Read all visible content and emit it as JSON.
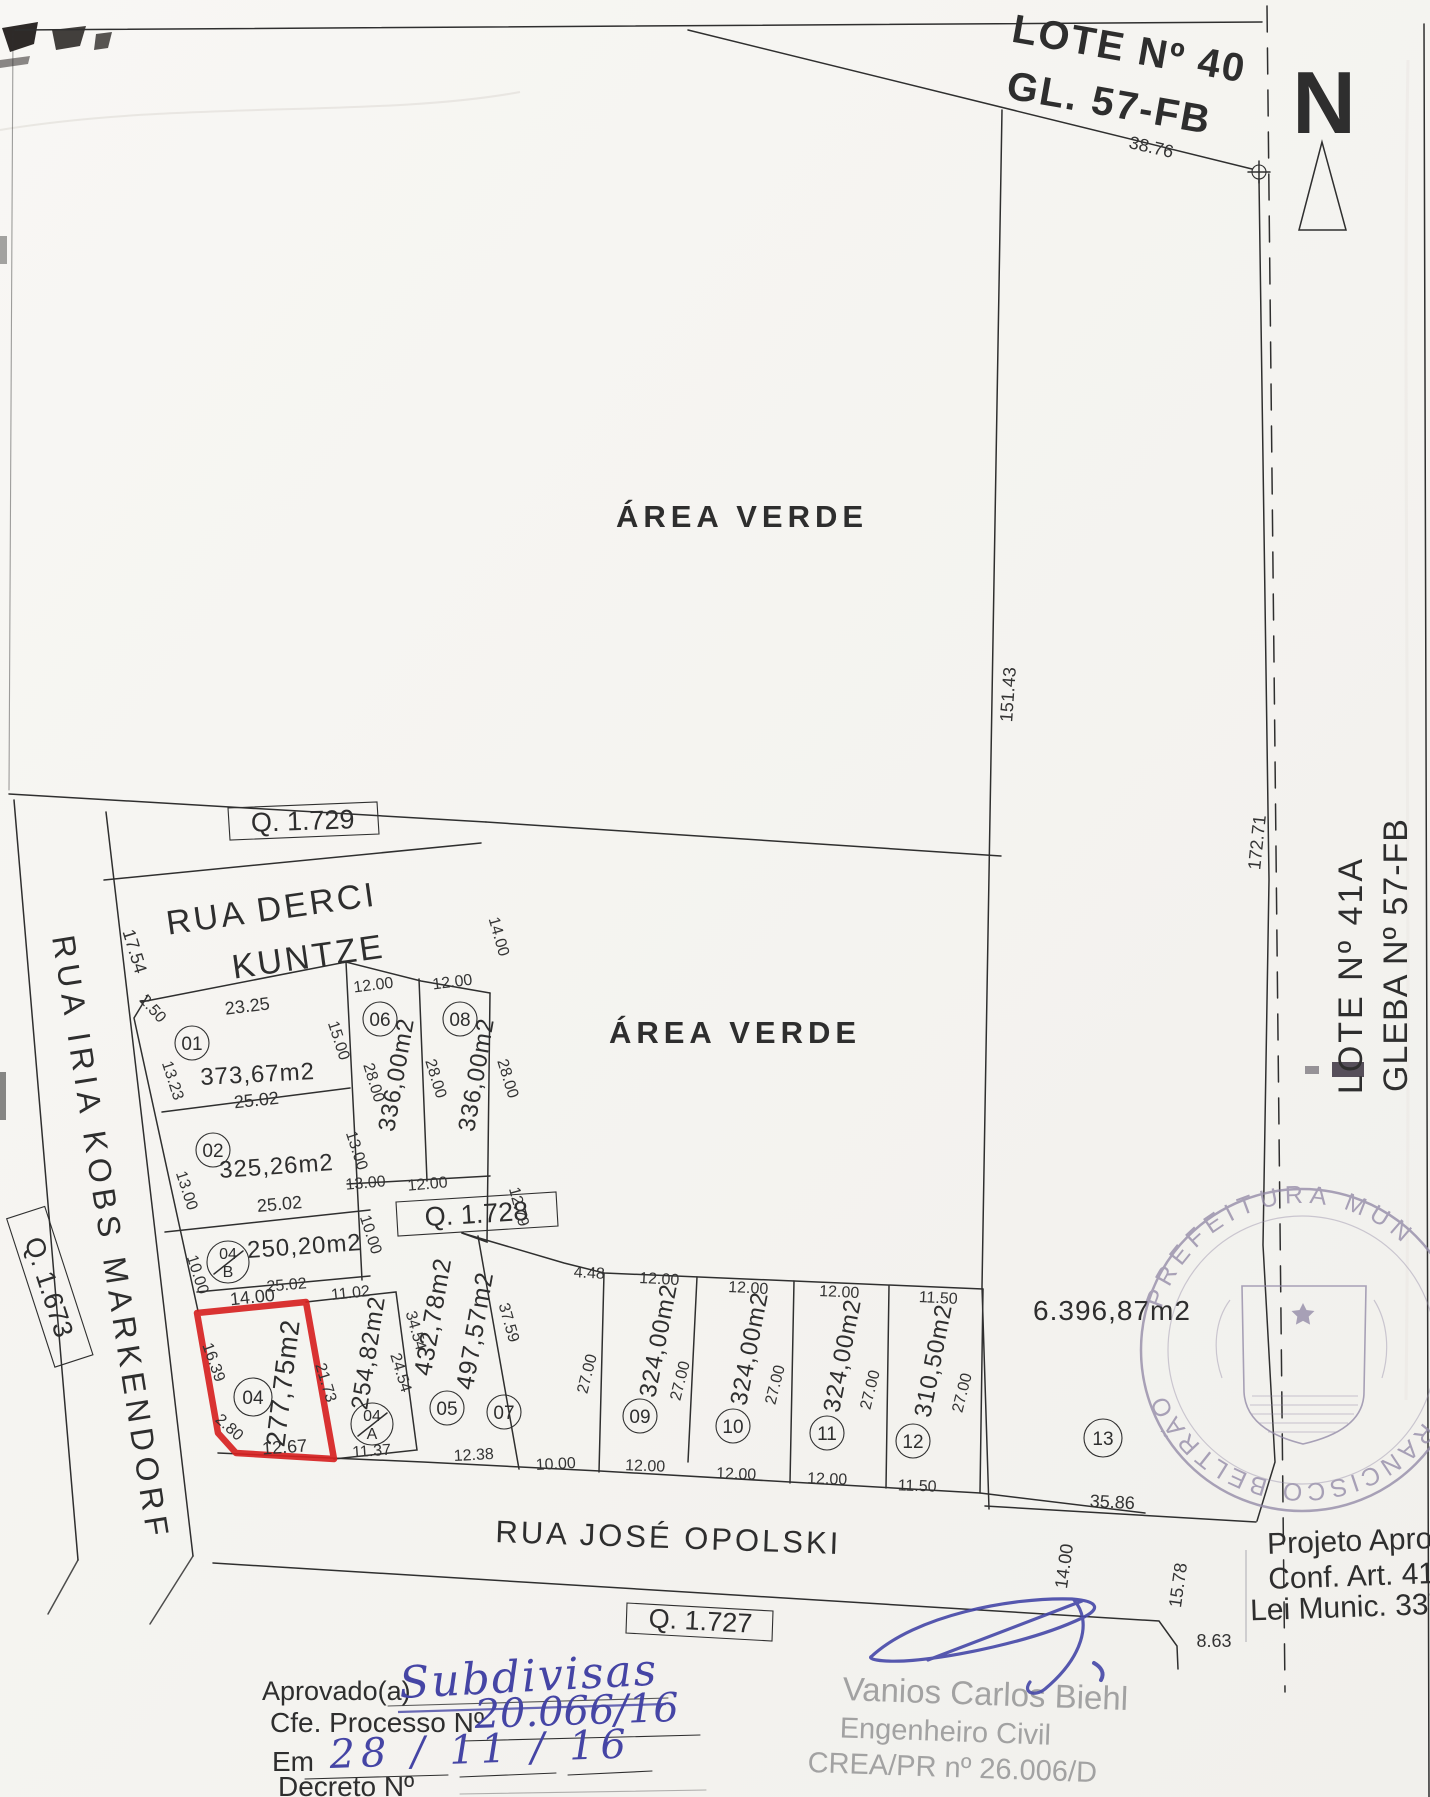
{
  "north": {
    "label": "N"
  },
  "header": {
    "lote40_line1": "LOTE Nº 40",
    "lote40_line2": "GL. 57-FB",
    "dim_top": "38.76"
  },
  "green_areas": {
    "upper": "ÁREA VERDE",
    "lower": "ÁREA VERDE"
  },
  "quadras": {
    "q1729": "Q. 1.729",
    "q1728": "Q. 1.728",
    "q1727": "Q. 1.727",
    "q1673": "Q. 1.673"
  },
  "streets": {
    "derci_line1": "RUA DERCI",
    "derci_line2": "KUNTZE",
    "iria": "RUA IRIA KOBS MARKENDORF",
    "jose": "RUA JOSÉ OPOLSKI"
  },
  "east_side": {
    "dim_151": "151.43",
    "dim_172": "172.71",
    "lote41a": "LOTE Nº 41A",
    "gleba": "GLEBA Nº 57-FB"
  },
  "misc_dims": {
    "d17_54": "17.54",
    "road_14": "14.00",
    "d15_78": "15.78",
    "d8_63": "8.63"
  },
  "lots": [
    {
      "number": "01",
      "area": "373,67m2",
      "front": "23.25",
      "chamfer": "2.50",
      "left": "13.23",
      "right": "15.00",
      "back": "25.02"
    },
    {
      "number": "02",
      "area": "325,26m2",
      "left": "13.00",
      "right": "13.00",
      "back": "25.02"
    },
    {
      "number": "04",
      "suffix": "B",
      "area": "250,20m2",
      "left": "10.00",
      "right": "10.00",
      "back": "25.02"
    },
    {
      "number": "04",
      "area": "277,75m2",
      "front": "14.00",
      "left": "16.39",
      "chamfer": "2.80",
      "bottom": "12.67",
      "right": "21.73"
    },
    {
      "number": "04",
      "suffix": "A",
      "area": "254,82m2",
      "front": "11.02",
      "right": "24.54",
      "bottom": "11.37"
    },
    {
      "number": "05",
      "area": "432,78m2",
      "left": "34.54",
      "bottom": "12.38"
    },
    {
      "number": "06",
      "area": "336,00m2",
      "front": "12.00",
      "left": "28.00",
      "bottom": "13.00"
    },
    {
      "number": "07",
      "area": "497,57m2",
      "top": "4.48",
      "left": "37.59",
      "right": "27.00",
      "bottom": "10.00"
    },
    {
      "number": "08",
      "area": "336,00m2",
      "front": "12.00",
      "street_side": "14.00",
      "left": "28.00",
      "right": "28.00",
      "bottom": "12.00",
      "east_edge": "12.79"
    },
    {
      "number": "09",
      "area": "324,00m2",
      "front": "12.00",
      "right": "27.00",
      "bottom": "12.00"
    },
    {
      "number": "10",
      "area": "324,00m2",
      "front": "12.00",
      "right": "27.00",
      "bottom": "12.00"
    },
    {
      "number": "11",
      "area": "324,00m2",
      "front": "12.00",
      "right": "27.00",
      "bottom": "12.00"
    },
    {
      "number": "12",
      "area": "310,50m2",
      "front": "11.50",
      "right": "27.00",
      "bottom": "11.50"
    },
    {
      "number": "13",
      "area": "6.396,87m2",
      "bottom": "35.86"
    }
  ],
  "seal": {
    "arc_top": "PREFEITURA MUN",
    "arc_bottom": "FRANCISCO BELTRÃO"
  },
  "approval_note": {
    "line1": "Projeto Apro",
    "line2": "Conf. Art. 41",
    "line3": "Lei Munic. 337"
  },
  "form": {
    "approved_label": "Aprovado(a)",
    "approved_value": "Subdivisas",
    "process_label": "Cfe. Processo Nº",
    "process_value": "20.066/16",
    "date_label": "Em",
    "date_value": "28 / 11 / 16",
    "decree_label": "Decreto Nº"
  },
  "signature": {
    "name": "Vanios Carlos Biehl",
    "title": "Engenheiro Civil",
    "registry": "CREA/PR nº 26.006/D"
  }
}
